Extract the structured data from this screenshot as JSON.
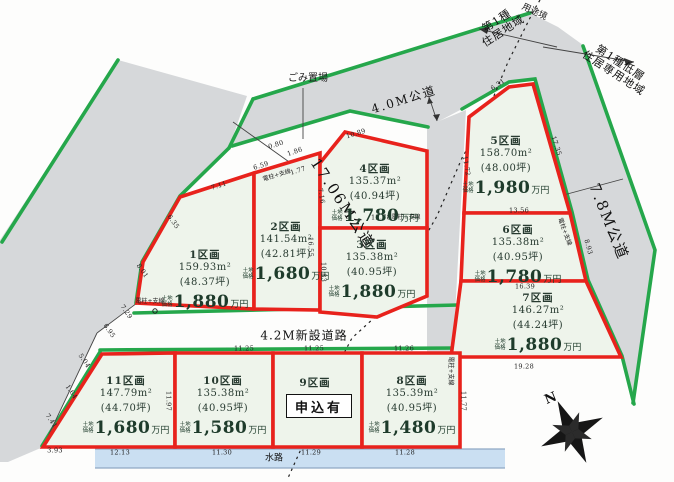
{
  "map_type": "land-subdivision-plan",
  "colors": {
    "plot_outline": "#e8221c",
    "road_edge": "#25a74b",
    "plot_fill": "#eef4eb",
    "road_fill": "#d6d8da",
    "water_fill": "#cadff2",
    "price_text": "#1e3b2b"
  },
  "roads": {
    "left": "17.06M公道",
    "top": "4.0M公道",
    "right": "7.8M公道",
    "new_road": "4.2M新設道路"
  },
  "zoning": {
    "left_line1": "第1種",
    "left_line2": "住居地域",
    "right_line1": "第1種低層",
    "right_line2": "住居専用地域",
    "boundary": "用途境"
  },
  "labels": {
    "garbage": "ごみ置場",
    "waterway": "水路",
    "north": "N",
    "application": "申込有",
    "utility": "電柱+支線",
    "price_prefix_line1": "土地",
    "price_prefix_line2": "価格",
    "price_suffix": "万円"
  },
  "plots": [
    {
      "name": "1区画",
      "area": "159.93m²",
      "tsubo": "(48.37坪)",
      "price": "1,880"
    },
    {
      "name": "2区画",
      "area": "141.54m²",
      "tsubo": "(42.81坪)",
      "price": "1,680"
    },
    {
      "name": "3区画",
      "area": "135.38m²",
      "tsubo": "(40.95坪)",
      "price": "1,880"
    },
    {
      "name": "4区画",
      "area": "135.37m²",
      "tsubo": "(40.94坪)",
      "price": "1,780"
    },
    {
      "name": "5区画",
      "area": "158.70m²",
      "tsubo": "(48.00坪)",
      "price": "1,980"
    },
    {
      "name": "6区画",
      "area": "135.38m²",
      "tsubo": "(40.95坪)",
      "price": "1,780"
    },
    {
      "name": "7区画",
      "area": "146.27m²",
      "tsubo": "(44.24坪)",
      "price": "1,880"
    },
    {
      "name": "8区画",
      "area": "135.39m²",
      "tsubo": "(40.95坪)",
      "price": "1,480"
    },
    {
      "name": "9区画",
      "status": "申込有"
    },
    {
      "name": "10区画",
      "area": "135.38m²",
      "tsubo": "(40.95坪)",
      "price": "1,580"
    },
    {
      "name": "11区画",
      "area": "147.79m²",
      "tsubo": "(44.70坪)",
      "price": "1,680"
    }
  ],
  "dims": [
    "7.11",
    "6.59",
    "0.80",
    "1.86",
    "1.77",
    "10.89",
    "6.31",
    "6.35",
    "8.01",
    "7.29",
    "6.95",
    "5.04",
    "1.64",
    "7.41",
    "16.55",
    "10.83",
    "12.78",
    "13.56",
    "16.39",
    "19.28",
    "17.35",
    "8.93",
    "11.72",
    "11.97",
    "11.77",
    "3.93",
    "12.13",
    "11.30",
    "11.29",
    "11.28",
    "11.25",
    "11.25",
    "11.26",
    "7.16"
  ]
}
